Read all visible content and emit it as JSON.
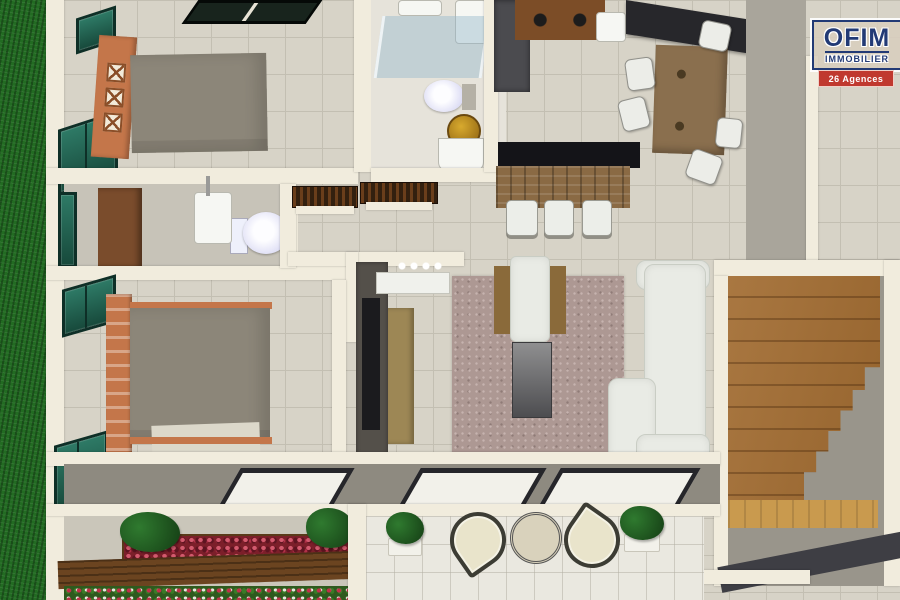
{
  "logo": {
    "brand": "OFIM",
    "subtitle": "IMMOBILIER",
    "badge": "26 Agences"
  },
  "colors": {
    "grass": "#226b22",
    "tile": "#d7d3c7",
    "tile-line": "#c3bfb2",
    "wall": "#f1ecdd",
    "floor-bath": "#c7c3b8",
    "floor-gray": "#b2aea3",
    "corridor": "#a9a59b",
    "stair-floor": "#99958b",
    "terrace-gray": "#8e8a80",
    "glass-teal": "#2e7a66",
    "glass-teal-dark": "#0e2f27",
    "bed-frame": "#c4764a",
    "bed-spread": "#8c8679",
    "sheet": "#dcd8ca",
    "door-wood": "#7a4c2c",
    "slat-dark": "#33200f",
    "counter-dark": "#27272b",
    "appliance-dark": "#4b4b4f",
    "counter-wood": "#7c4d27",
    "island-top": "#141418",
    "island-wood": "#8a6a44",
    "stool-white": "#eceee9",
    "table-wood": "#8a6f4e",
    "chair-white": "#ecede8",
    "rug": "#ad9893",
    "sofa": "#e9ebe5",
    "coffee-top": "#8f8f90",
    "tv-dark": "#54504a",
    "screen-black": "#1b1b1e",
    "sideboard": "#9d8755",
    "stairs": "#a26c31",
    "landing": "#c99a4e",
    "pane-frame": "#26262a",
    "pane-glass": "#f2f1ea",
    "plant": "#1d4f1d",
    "flower-red": "#9c1f2e",
    "beam": "#6b4420",
    "patio-tile": "#eae8e0",
    "iron": "#3c3c34",
    "cream": "#e9e4cb",
    "logo-blue": "#223a75",
    "logo-red": "#c0392f"
  }
}
